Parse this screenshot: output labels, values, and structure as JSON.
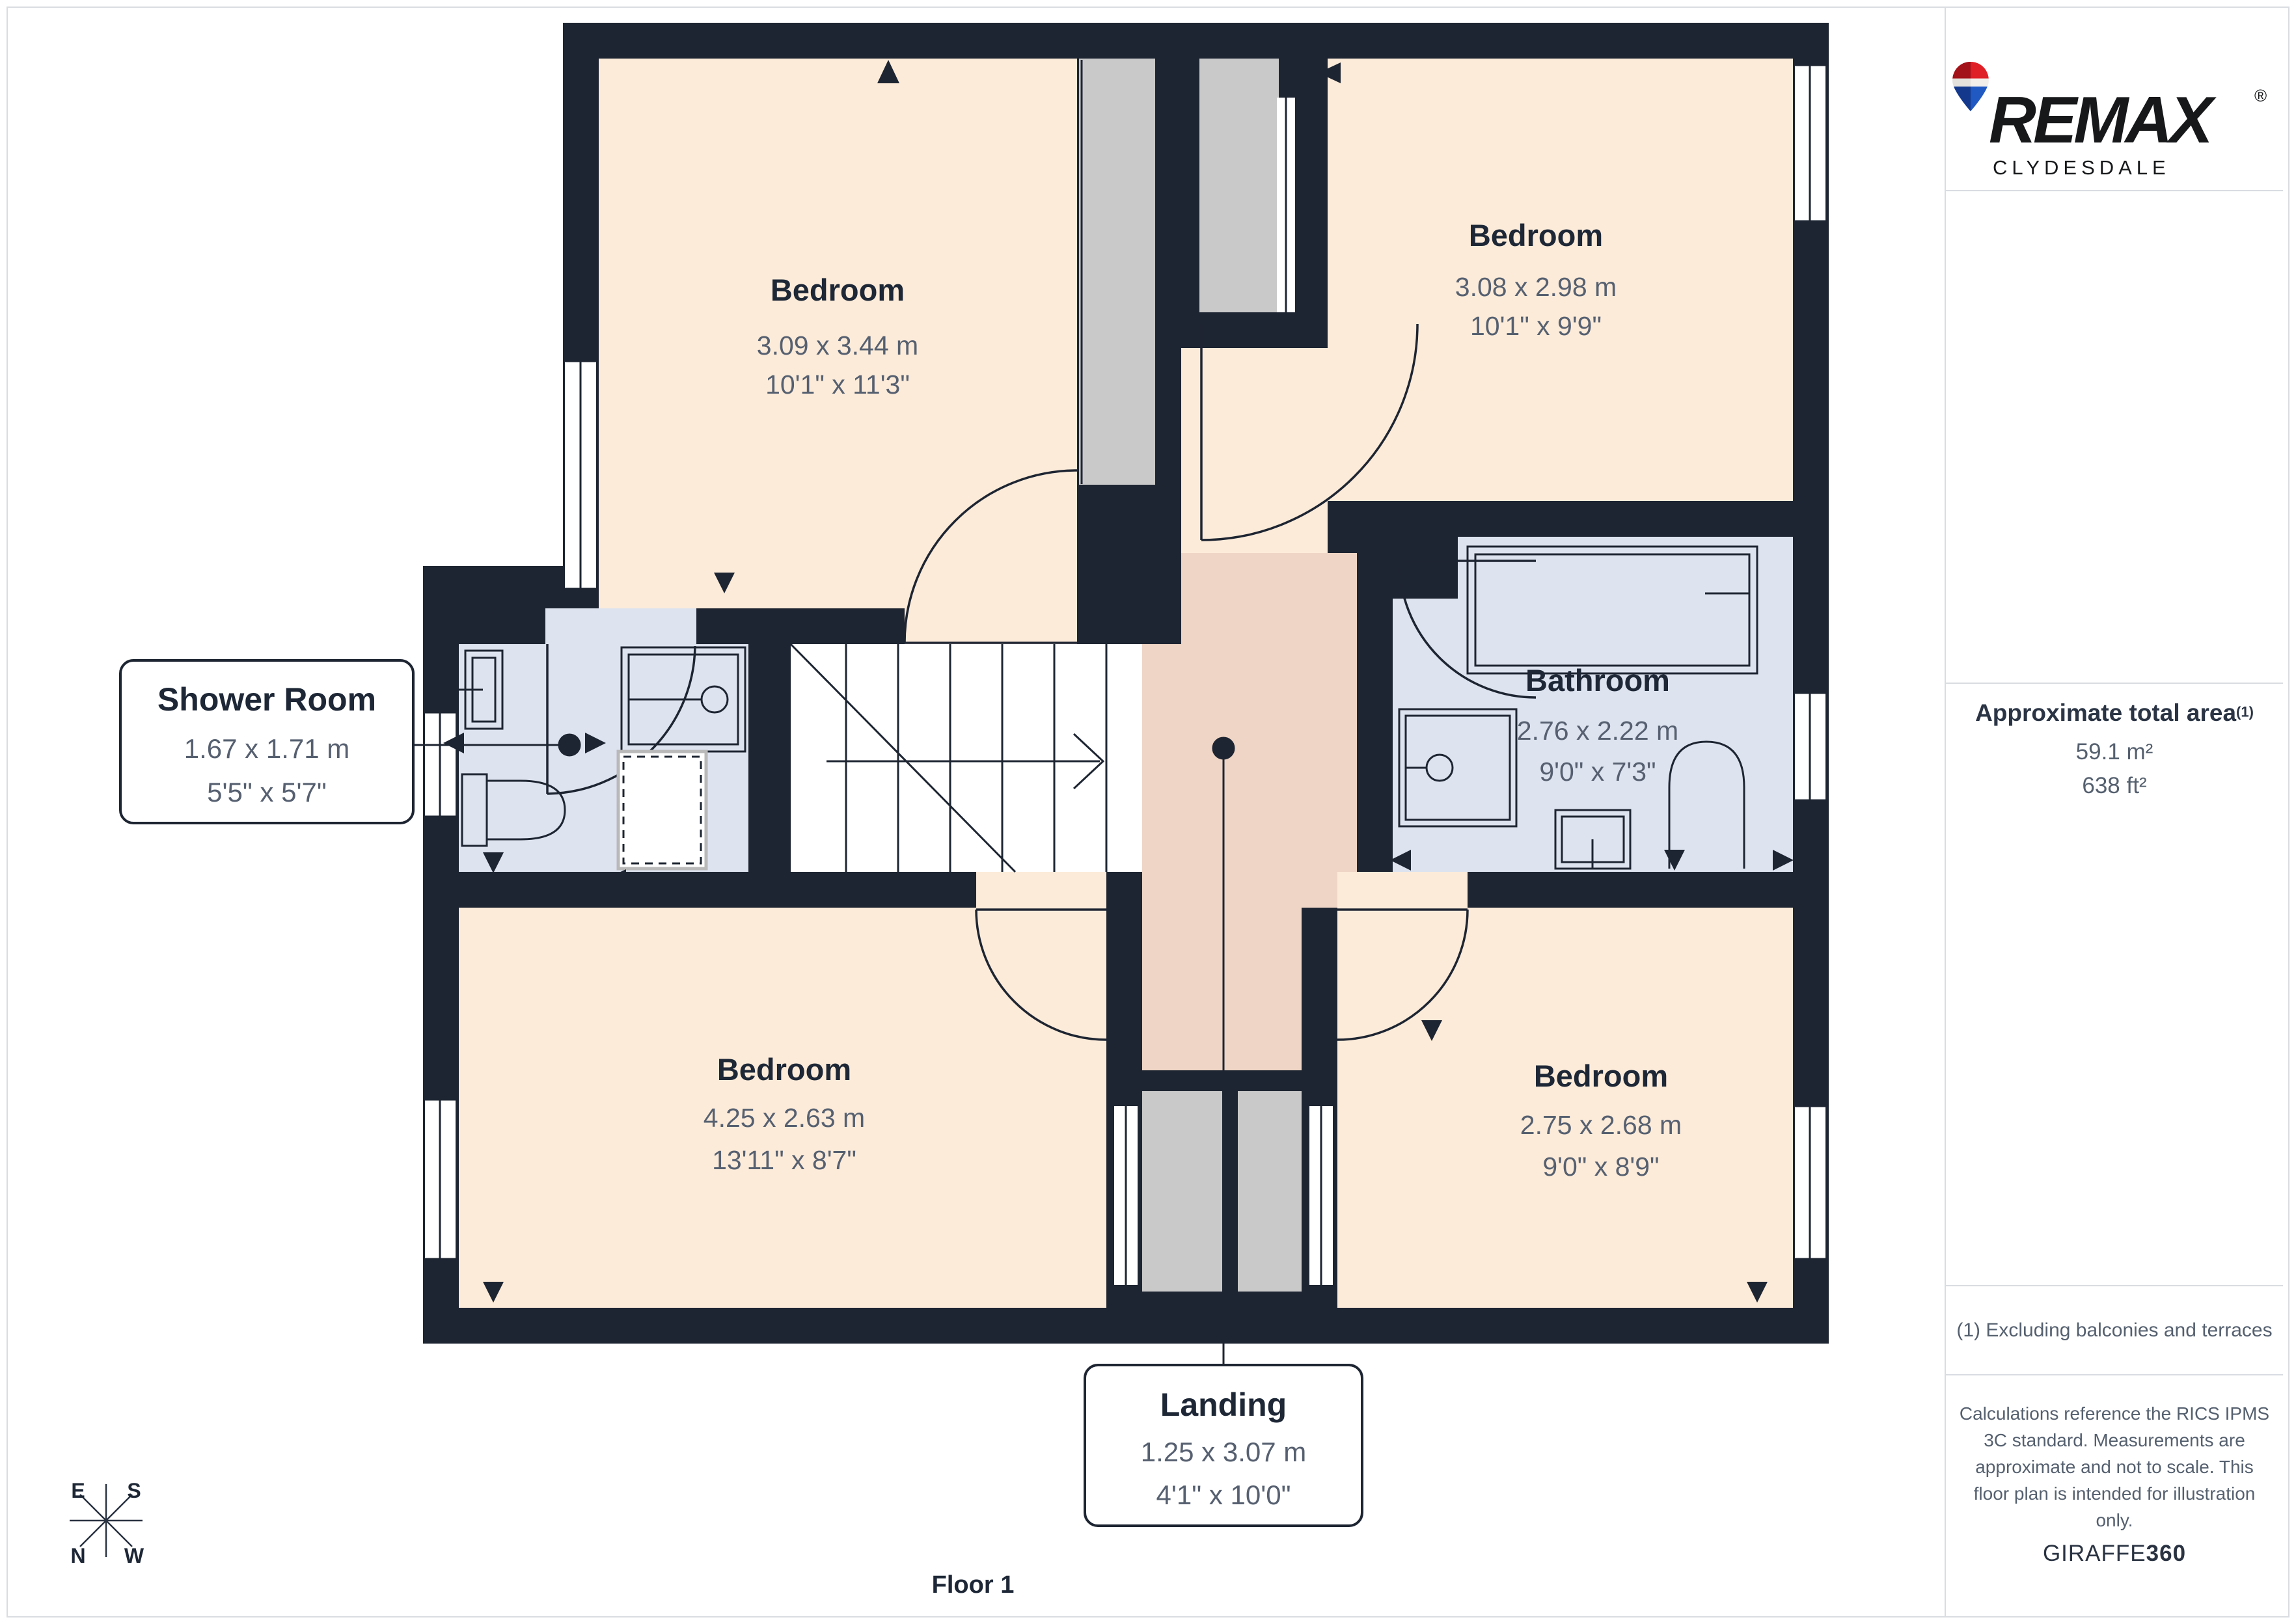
{
  "plan": {
    "floor_label": "Floor 1",
    "rooms": {
      "bedroom_tl": {
        "label": "Bedroom",
        "metric": "3.09 x 3.44 m",
        "imperial": "10'1\" x 11'3\""
      },
      "bedroom_tr": {
        "label": "Bedroom",
        "metric": "3.08 x 2.98 m",
        "imperial": "10'1\" x 9'9\""
      },
      "bathroom": {
        "label": "Bathroom",
        "metric": "2.76 x 2.22 m",
        "imperial": "9'0\" x 7'3\""
      },
      "shower_room": {
        "label": "Shower Room",
        "metric": "1.67 x 1.71 m",
        "imperial": "5'5\" x 5'7\""
      },
      "bedroom_bl": {
        "label": "Bedroom",
        "metric": "4.25 x 2.63 m",
        "imperial": "13'11\" x 8'7\""
      },
      "bedroom_br": {
        "label": "Bedroom",
        "metric": "2.75 x 2.68 m",
        "imperial": "9'0\" x 8'9\""
      },
      "landing": {
        "label": "Landing",
        "metric": "1.25 x 3.07 m",
        "imperial": "4'1\" x 10'0\""
      }
    },
    "compass": {
      "e": "E",
      "s": "S",
      "n": "N",
      "w": "W"
    }
  },
  "sidebar": {
    "brand": {
      "name": "REMAX",
      "registered": "®",
      "office": "CLYDESDALE"
    },
    "area": {
      "title": "Approximate total area",
      "sup": "(1)",
      "metric": "59.1 m²",
      "imperial": "638 ft²"
    },
    "footnote": "(1) Excluding balconies and terraces",
    "disclaimer": "Calculations reference the RICS IPMS 3C standard. Measurements are approximate and not to scale. This floor plan is intended for illustration only.",
    "credit": {
      "brand": "GIRAFFE",
      "suffix": "360"
    }
  },
  "colors": {
    "wall": "#1e2532",
    "bedroom_fill": "#fcebd9",
    "wet_room_fill": "#dde3ef",
    "landing_fill": "#eed5c5",
    "shaft_fill": "#c9c9c9",
    "room_title": "#1d2736",
    "dimension_text": "#566070",
    "divider": "#d9dce1",
    "remax_red": "#e02027",
    "remax_blue": "#2159c3"
  }
}
